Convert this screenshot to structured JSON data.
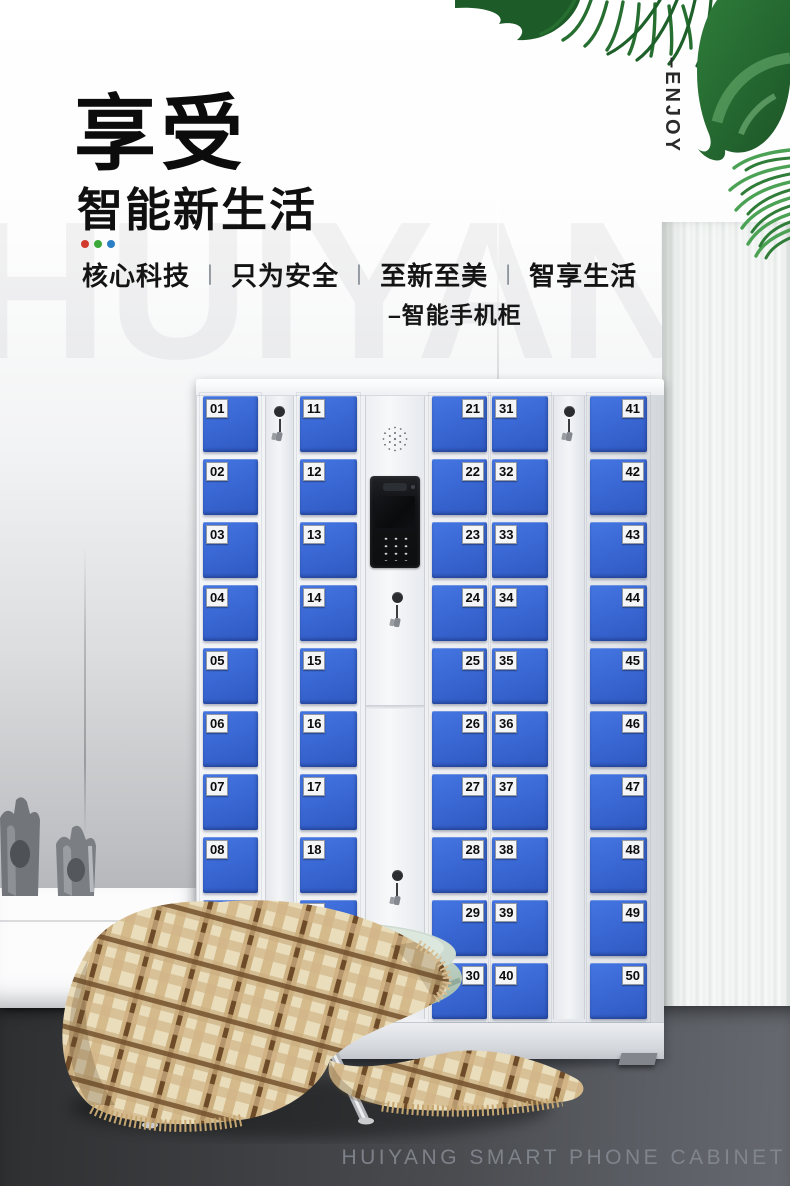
{
  "hero": {
    "title": "享受",
    "subtitle": "智能新生活",
    "tagline": {
      "items": [
        "核心科技",
        "只为安全",
        "至新至美",
        "智享生活"
      ],
      "separator": "丨"
    },
    "product_note": "–智能手机柜",
    "vertical_label": "–ENJOY",
    "accent_dots": [
      "#d23a2e",
      "#3aa93a",
      "#2b7fc4"
    ]
  },
  "watermark_text": "HUIYANG",
  "cabinet": {
    "door_color": "#3a68d4",
    "columns": [
      {
        "label_side": "left",
        "numbers": [
          "01",
          "02",
          "03",
          "04",
          "05",
          "06",
          "07",
          "08",
          "09",
          "10"
        ]
      },
      {
        "label_side": "left",
        "numbers": [
          "11",
          "12",
          "13",
          "14",
          "15",
          "16",
          "17",
          "18",
          "19",
          "20"
        ]
      },
      {
        "label_side": "right",
        "numbers": [
          "21",
          "22",
          "23",
          "24",
          "25",
          "26",
          "27",
          "28",
          "29",
          "30"
        ]
      },
      {
        "label_side": "left",
        "numbers": [
          "31",
          "32",
          "33",
          "34",
          "35",
          "36",
          "37",
          "38",
          "39",
          "40"
        ]
      },
      {
        "label_side": "right",
        "numbers": [
          "41",
          "42",
          "43",
          "44",
          "45",
          "46",
          "47",
          "48",
          "49",
          "50"
        ]
      }
    ]
  },
  "footer": {
    "caption": "HUIYANG SMART PHONE CABINET"
  }
}
